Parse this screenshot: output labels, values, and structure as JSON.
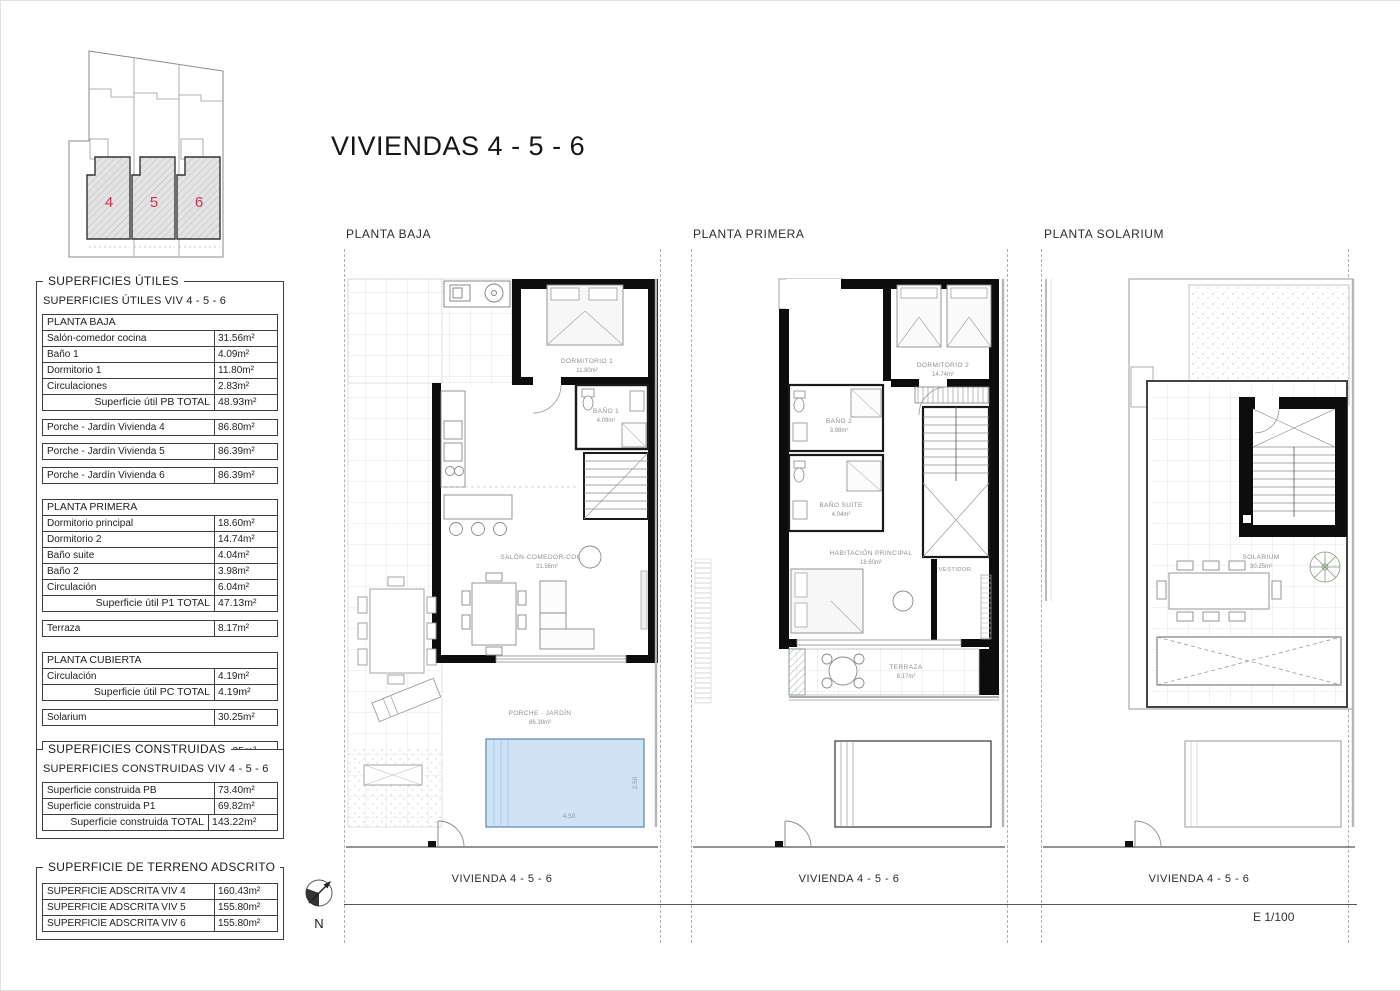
{
  "page": {
    "title": "VIVIENDAS 4 - 5 - 6",
    "scale_label": "E 1/100",
    "compass_label": "N"
  },
  "site_plan": {
    "houses": [
      {
        "number": "4"
      },
      {
        "number": "5"
      },
      {
        "number": "6"
      }
    ],
    "number_color": "#cc3350"
  },
  "useful_areas": {
    "box_title": "SUPERFICIES ÚTILES",
    "subtitle": "SUPERFICIES ÚTILES VIV 4 - 5 - 6",
    "planta_baja": {
      "header": "PLANTA BAJA",
      "rows": [
        {
          "label": "Salón-comedor cocina",
          "value": "31.56m²"
        },
        {
          "label": "Baño 1",
          "value": "4.09m²"
        },
        {
          "label": "Dormitorio 1",
          "value": "11.80m²"
        },
        {
          "label": "Circulaciones",
          "value": "2.83m²"
        }
      ],
      "total": {
        "label": "Superficie útil PB TOTAL",
        "value": "48.93m²"
      }
    },
    "porche_rows": [
      {
        "label": "Porche - Jardín Vivienda 4",
        "value": "86.80m²"
      },
      {
        "label": "Porche - Jardín Vivienda 5",
        "value": "86.39m²"
      },
      {
        "label": "Porche - Jardín Vivienda 6",
        "value": "86.39m²"
      }
    ],
    "planta_primera": {
      "header": "PLANTA PRIMERA",
      "rows": [
        {
          "label": "Dormitorio principal",
          "value": "18.60m²"
        },
        {
          "label": "Dormitorio 2",
          "value": "14.74m²"
        },
        {
          "label": "Baño suite",
          "value": "4.04m²"
        },
        {
          "label": "Baño 2",
          "value": "3.98m²"
        },
        {
          "label": "Circulación",
          "value": "6.04m²"
        }
      ],
      "total": {
        "label": "Superficie útil P1 TOTAL",
        "value": "47.13m²"
      }
    },
    "terraza_row": {
      "label": "Terraza",
      "value": "8.17m²"
    },
    "planta_cubierta": {
      "header": "PLANTA CUBIERTA",
      "rows": [
        {
          "label": "Circulación",
          "value": "4.19m²"
        }
      ],
      "total": {
        "label": "Superficie útil PC TOTAL",
        "value": "4.19m²"
      }
    },
    "solarium_row": {
      "label": "Solarium",
      "value": "30.25m²"
    },
    "grand_total": {
      "label": "SUPERFICIE ÚTIL TOTAL",
      "value": "100.25m²"
    }
  },
  "built_areas": {
    "box_title": "SUPERFICIES CONSTRUIDAS",
    "subtitle": "SUPERFICIES CONSTRUIDAS VIV 4 - 5 - 6",
    "rows": [
      {
        "label": "Superficie construida PB",
        "value": "73.40m²"
      },
      {
        "label": "Superficie construida P1",
        "value": "69.82m²"
      }
    ],
    "total": {
      "label": "Superficie construida TOTAL",
      "value": "143.22m²"
    }
  },
  "land_areas": {
    "box_title": "SUPERFICIE DE TERRENO ADSCRITO",
    "rows": [
      {
        "label": "SUPERFICIE ADSCRITA VIV 4",
        "value": "160.43m²"
      },
      {
        "label": "SUPERFICIE ADSCRITA VIV 5",
        "value": "155.80m²"
      },
      {
        "label": "SUPERFICIE ADSCRITA VIV 6",
        "value": "155.80m²"
      }
    ]
  },
  "plans": {
    "baja": {
      "title": "PLANTA BAJA",
      "vivienda_label": "VIVIENDA 4 - 5 - 6",
      "rooms": {
        "dormitorio1": {
          "name": "DORMITORIO 1",
          "area": "11.80m²"
        },
        "bano1": {
          "name": "BAÑO 1",
          "area": "4.09m²"
        },
        "salon": {
          "name": "SALÓN-COMEDOR-COCINA",
          "area": "31.56m²"
        },
        "porche": {
          "name": "PORCHE - JARDÍN",
          "area": "86.39m²"
        }
      },
      "pool": {
        "width_label": "4.50",
        "height_label": "2.50",
        "fill": "#cfe2f6"
      }
    },
    "primera": {
      "title": "PLANTA PRIMERA",
      "vivienda_label": "VIVIENDA 4 - 5 - 6",
      "rooms": {
        "dormitorio2": {
          "name": "DORMITORIO 2",
          "area": "14.74m²"
        },
        "bano2": {
          "name": "BAÑO 2",
          "area": "3.98m²"
        },
        "banosuite": {
          "name": "BAÑO SUITE",
          "area": "4.04m²"
        },
        "principal": {
          "name": "HABITACIÓN PRINCIPAL",
          "area": "18.60m²"
        },
        "vestidor": {
          "name": "VESTIDOR"
        },
        "terraza": {
          "name": "TERRAZA",
          "area": "8.17m²"
        }
      }
    },
    "solarium": {
      "title": "PLANTA SOLARIUM",
      "vivienda_label": "VIVIENDA 4 - 5 - 6",
      "rooms": {
        "solarium": {
          "name": "SOLARIUM",
          "area": "30.25m²"
        }
      }
    }
  }
}
